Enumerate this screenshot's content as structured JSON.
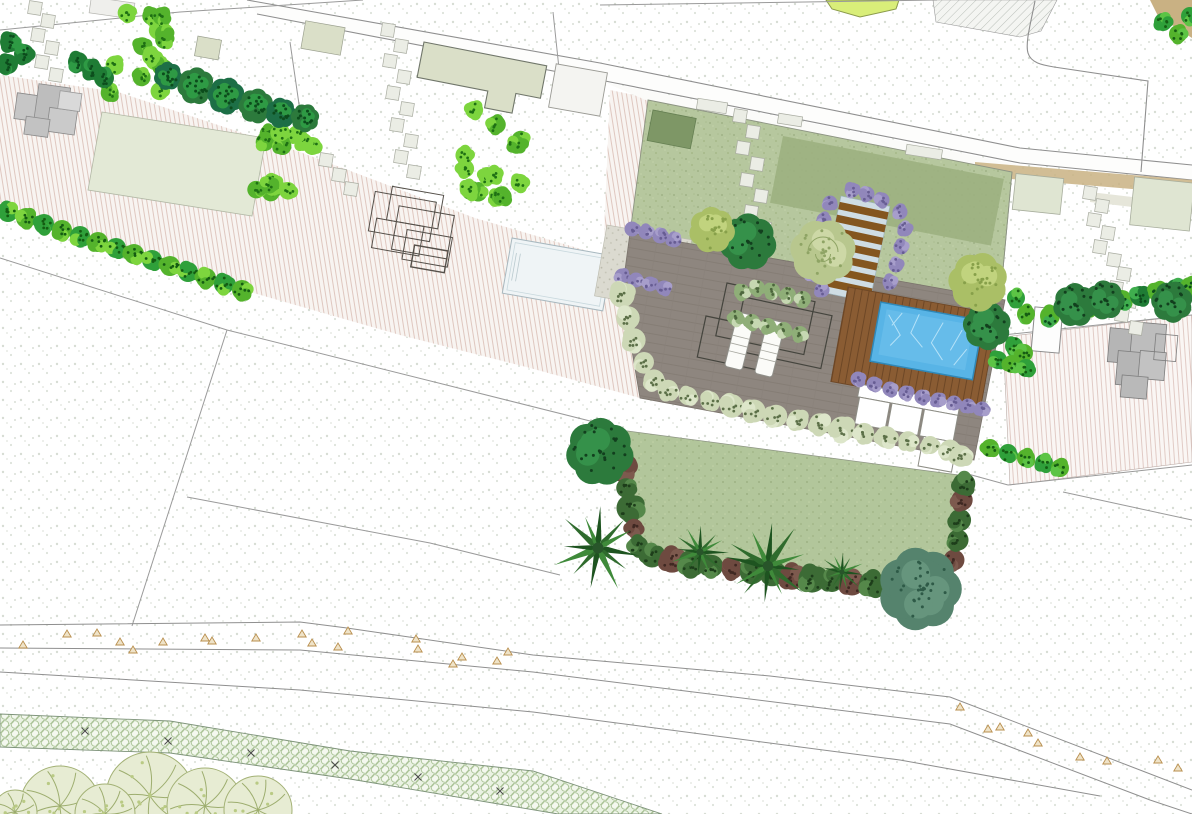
{
  "document": {
    "type": "landscape-site-plan",
    "title": "Garden design site plan (top view)",
    "visible_text": []
  },
  "colors": {
    "paper": "#ffffff",
    "stipple_dot": "#ccd3c8",
    "parcel_line": "#8f8f8f",
    "stripe_bg": "#f8f4f1",
    "stripe_line": "#ddc2ba",
    "lawn_front": "#b6c79e",
    "lawn_dark_patch": "#9cb080",
    "lawn_square": "#7e9766",
    "lawn_main": "#b2c69b",
    "lawn_pale": "#e3e9d6",
    "terrace": "#8e867f",
    "gravel": "#dbdad0",
    "pool_water": "#58b4e6",
    "neighbor_pool": "#eff4f6",
    "water_feature": "#a9cfe2",
    "deck_wood": "#8a5c33",
    "step_tread": "#84561f",
    "step_pale": "#cfdde4",
    "building_gray": "#c2c2c2",
    "building_sage": "#dadfc8",
    "shed_white": "#f4f4f1",
    "hedge_lime": "#54b32c",
    "hedge_lime_light": "#7dd53e",
    "shrub_dark": "#1f7c35",
    "shrub_sage": "#cdd8b6",
    "shrub_purple": "#9187bb",
    "shrub_maroon": "#6e4a40",
    "tree_dark": "#2c7a3c",
    "tree_olive": "#aabf66",
    "tree_swirl": "#b8c78e",
    "tree_teal": "#55836d",
    "tree_sketch": "#e7ecd3",
    "palm_frond": "#2f6b2d",
    "chartreuse": "#d9ee79",
    "tan_band": "#c9b183",
    "survey_triangle": "#b98f4e",
    "paver_band_bg": "#eaf2e3",
    "paver_band_line": "#a9c295"
  },
  "features": {
    "stones_tl": [
      [
        35,
        8
      ],
      [
        48,
        21
      ],
      [
        38,
        35
      ],
      [
        52,
        48
      ],
      [
        42,
        62
      ],
      [
        56,
        75
      ]
    ],
    "stones_mid": [
      [
        388,
        30
      ],
      [
        401,
        46
      ],
      [
        390,
        61
      ],
      [
        404,
        77
      ],
      [
        393,
        93
      ],
      [
        407,
        109
      ],
      [
        397,
        125
      ],
      [
        411,
        141
      ],
      [
        401,
        157
      ],
      [
        414,
        172
      ],
      [
        326,
        160
      ],
      [
        339,
        175
      ],
      [
        351,
        189
      ]
    ],
    "stones_lawn": [
      [
        740,
        116
      ],
      [
        753,
        132
      ],
      [
        743,
        148
      ],
      [
        757,
        164
      ],
      [
        747,
        180
      ],
      [
        761,
        196
      ],
      [
        751,
        212
      ],
      [
        764,
        228
      ],
      [
        754,
        244
      ]
    ],
    "stone_bars": [
      [
        712,
        106,
        30,
        11
      ],
      [
        790,
        120,
        24,
        10
      ],
      [
        924,
        152,
        36,
        10
      ]
    ],
    "stones_right": [
      [
        1090,
        193
      ],
      [
        1102,
        206
      ],
      [
        1094,
        220
      ],
      [
        1108,
        233
      ],
      [
        1100,
        247
      ],
      [
        1114,
        260
      ],
      [
        1124,
        274
      ],
      [
        1116,
        288
      ],
      [
        1130,
        301
      ],
      [
        1122,
        315
      ],
      [
        1136,
        328
      ]
    ],
    "hedge_rects": [
      [
        116,
        6,
        56,
        92,
        8,
        16
      ],
      [
        470,
        108,
        62,
        92,
        8,
        16
      ],
      [
        262,
        128,
        58,
        17,
        10,
        7
      ],
      [
        256,
        178,
        50,
        16,
        10,
        6
      ]
    ],
    "hedge_row_left": [
      [
        8,
        212
      ],
      [
        26,
        218
      ],
      [
        44,
        224
      ],
      [
        62,
        230
      ],
      [
        80,
        236
      ],
      [
        98,
        242
      ],
      [
        116,
        248
      ],
      [
        134,
        254
      ],
      [
        152,
        260
      ],
      [
        170,
        266
      ],
      [
        188,
        272
      ],
      [
        206,
        278
      ],
      [
        224,
        284
      ],
      [
        242,
        290
      ]
    ],
    "hedge_row_right": [
      [
        1050,
        316
      ],
      [
        1068,
        312
      ],
      [
        1086,
        308
      ],
      [
        1104,
        304
      ],
      [
        1122,
        300
      ],
      [
        1140,
        296
      ],
      [
        1158,
        292
      ],
      [
        1176,
        289
      ],
      [
        1190,
        287
      ]
    ],
    "green_bits": [
      [
        1016,
        298
      ],
      [
        1026,
        314
      ],
      [
        1014,
        346
      ],
      [
        1024,
        353
      ],
      [
        998,
        360
      ],
      [
        1012,
        364
      ],
      [
        1026,
        368
      ],
      [
        990,
        448
      ],
      [
        1008,
        453
      ],
      [
        1026,
        458
      ],
      [
        1044,
        463
      ],
      [
        1060,
        468
      ],
      [
        1163,
        22
      ],
      [
        1178,
        34
      ],
      [
        1190,
        16
      ]
    ],
    "shrubs_dark_tl": [
      [
        10,
        42
      ],
      [
        24,
        54
      ],
      [
        8,
        64
      ],
      [
        78,
        62
      ],
      [
        92,
        70
      ],
      [
        104,
        78
      ]
    ],
    "trees_row": [
      [
        168,
        76,
        13
      ],
      [
        196,
        86,
        17
      ],
      [
        226,
        96,
        17
      ],
      [
        256,
        106,
        16
      ],
      [
        281,
        113,
        14
      ],
      [
        305,
        118,
        13
      ]
    ],
    "purple": [
      [
        632,
        229
      ],
      [
        646,
        232
      ],
      [
        660,
        236
      ],
      [
        674,
        240
      ],
      [
        622,
        276
      ],
      [
        636,
        280
      ],
      [
        650,
        284
      ],
      [
        664,
        288
      ],
      [
        858,
        379
      ],
      [
        874,
        384
      ],
      [
        890,
        389
      ],
      [
        906,
        393
      ],
      [
        922,
        397
      ],
      [
        938,
        400
      ],
      [
        954,
        403
      ],
      [
        968,
        406
      ],
      [
        982,
        409
      ],
      [
        830,
        203
      ],
      [
        824,
        220
      ],
      [
        819,
        238
      ],
      [
        815,
        256
      ],
      [
        812,
        274
      ],
      [
        822,
        290
      ],
      [
        900,
        212
      ],
      [
        905,
        229
      ],
      [
        901,
        247
      ],
      [
        896,
        265
      ],
      [
        890,
        282
      ],
      [
        852,
        190
      ],
      [
        867,
        194
      ],
      [
        882,
        200
      ]
    ],
    "border_sage": [
      [
        622,
        295
      ],
      [
        628,
        318
      ],
      [
        634,
        340
      ],
      [
        644,
        362
      ],
      [
        654,
        380
      ],
      [
        668,
        390
      ],
      [
        688,
        396
      ],
      [
        710,
        401
      ],
      [
        732,
        406
      ],
      [
        754,
        411
      ],
      [
        776,
        416
      ],
      [
        798,
        420
      ],
      [
        820,
        424
      ],
      [
        842,
        429
      ],
      [
        864,
        433
      ],
      [
        886,
        437
      ],
      [
        908,
        441
      ],
      [
        930,
        445
      ],
      [
        950,
        450
      ],
      [
        961,
        456
      ]
    ],
    "planter_green": [
      [
        742,
        292
      ],
      [
        757,
        288
      ],
      [
        772,
        291
      ],
      [
        788,
        295
      ],
      [
        803,
        299
      ],
      [
        736,
        318
      ],
      [
        752,
        322
      ],
      [
        768,
        326
      ],
      [
        784,
        330
      ],
      [
        800,
        334
      ]
    ],
    "border_lawn": [
      [
        618,
        448
      ],
      [
        622,
        468
      ],
      [
        626,
        488
      ],
      [
        630,
        508
      ],
      [
        634,
        528
      ],
      [
        638,
        546
      ],
      [
        652,
        556
      ],
      [
        672,
        560
      ],
      [
        692,
        563
      ],
      [
        712,
        566
      ],
      [
        732,
        569
      ],
      [
        752,
        572
      ],
      [
        772,
        574
      ],
      [
        792,
        577
      ],
      [
        812,
        579
      ],
      [
        832,
        581
      ],
      [
        852,
        583
      ],
      [
        872,
        584
      ],
      [
        892,
        585
      ],
      [
        912,
        586
      ],
      [
        930,
        586
      ],
      [
        948,
        582
      ],
      [
        954,
        560
      ],
      [
        958,
        540
      ],
      [
        960,
        520
      ],
      [
        962,
        500
      ],
      [
        964,
        484
      ]
    ],
    "trees_dark": [
      [
        600,
        452,
        31
      ],
      [
        748,
        242,
        26
      ],
      [
        987,
        326,
        22
      ],
      [
        1075,
        305,
        20
      ],
      [
        1105,
        300,
        18
      ],
      [
        1172,
        302,
        19
      ]
    ],
    "trees_olive": [
      [
        712,
        230,
        21
      ],
      [
        978,
        282,
        27
      ]
    ],
    "trees_swirl": [
      [
        823,
        252,
        30
      ]
    ],
    "trees_teal": [
      [
        920,
        589,
        38
      ]
    ],
    "palms": [
      [
        598,
        548,
        46
      ],
      [
        700,
        552,
        30
      ],
      [
        768,
        566,
        44
      ],
      [
        842,
        572,
        22
      ]
    ],
    "sketch_trees": [
      [
        60,
        806,
        40
      ],
      [
        150,
        796,
        44
      ],
      [
        205,
        806,
        38
      ],
      [
        258,
        810,
        34
      ],
      [
        15,
        812,
        22
      ],
      [
        105,
        814,
        30
      ]
    ],
    "triangles": [
      [
        23,
        645
      ],
      [
        67,
        634
      ],
      [
        97,
        633
      ],
      [
        120,
        642
      ],
      [
        133,
        650
      ],
      [
        163,
        642
      ],
      [
        205,
        638
      ],
      [
        212,
        641
      ],
      [
        256,
        638
      ],
      [
        302,
        634
      ],
      [
        312,
        643
      ],
      [
        338,
        647
      ],
      [
        348,
        631
      ],
      [
        416,
        639
      ],
      [
        418,
        649
      ],
      [
        462,
        657
      ],
      [
        453,
        664
      ],
      [
        497,
        661
      ],
      [
        508,
        652
      ],
      [
        960,
        707
      ],
      [
        988,
        729
      ],
      [
        1000,
        727
      ],
      [
        1028,
        733
      ],
      [
        1038,
        743
      ],
      [
        1080,
        757
      ],
      [
        1107,
        761
      ],
      [
        1158,
        760
      ],
      [
        1178,
        768
      ]
    ],
    "xmarks": [
      [
        85,
        731
      ],
      [
        168,
        741
      ],
      [
        251,
        753
      ],
      [
        335,
        765
      ],
      [
        418,
        777
      ],
      [
        500,
        791
      ]
    ]
  }
}
